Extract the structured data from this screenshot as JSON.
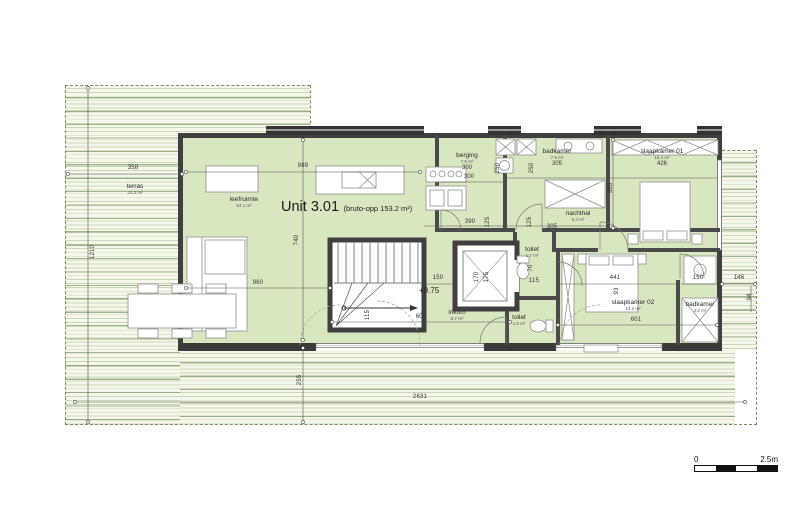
{
  "title": {
    "unit": "Unit 3.01",
    "gross": "(bruto-opp 153.2 m²)"
  },
  "annotations": {
    "level": "+9.75"
  },
  "scale_bar": {
    "left": "0",
    "right": "2.5m"
  },
  "plan": {
    "rooms": [
      {
        "name": "terras",
        "area": "43.3 m²",
        "x": 135,
        "y": 183
      },
      {
        "name": "leefruimte",
        "area": "54.1 m²",
        "x": 244,
        "y": 196
      },
      {
        "name": "berging",
        "area": "7.5 m²",
        "dim": "300",
        "x": 467,
        "y": 152
      },
      {
        "name": "badkamer",
        "area": "7.6 m²",
        "dim": "305",
        "x": 557,
        "y": 148
      },
      {
        "name": "slaapkamer 01",
        "area": "16.4 m²",
        "dim": "426",
        "x": 662,
        "y": 148
      },
      {
        "name": "nachthal",
        "area": "5.3 m²",
        "x": 578,
        "y": 210
      },
      {
        "name": "toilet",
        "area": "1.7 m²",
        "x": 532,
        "y": 246
      },
      {
        "name": "toilet",
        "area": "1.5 m²",
        "x": 519,
        "y": 314
      },
      {
        "name": "inkom",
        "area": "6.7 m²",
        "x": 457,
        "y": 309
      },
      {
        "name": "slaapkamer 02",
        "area": "13.2 m²",
        "x": 633,
        "y": 299
      },
      {
        "name": "badkamer",
        "area": "4.2 m²",
        "x": 700,
        "y": 301
      }
    ],
    "dimensions": [
      {
        "t": "358",
        "x": 133,
        "y": 168
      },
      {
        "t": "989",
        "x": 303,
        "y": 166
      },
      {
        "t": "1210",
        "x": 93,
        "y": 252,
        "r": true
      },
      {
        "t": "740",
        "x": 297,
        "y": 240,
        "r": true
      },
      {
        "t": "960",
        "x": 258,
        "y": 283
      },
      {
        "t": "300",
        "x": 469,
        "y": 177
      },
      {
        "t": "250",
        "x": 498,
        "y": 168,
        "r": true
      },
      {
        "t": "250",
        "x": 532,
        "y": 168,
        "r": true
      },
      {
        "t": "385",
        "x": 611,
        "y": 188,
        "r": true
      },
      {
        "t": "390",
        "x": 470,
        "y": 222
      },
      {
        "t": "125",
        "x": 488,
        "y": 222,
        "r": true
      },
      {
        "t": "125",
        "x": 530,
        "y": 222,
        "r": true
      },
      {
        "t": "305",
        "x": 552,
        "y": 227
      },
      {
        "t": "150",
        "x": 438,
        "y": 278
      },
      {
        "t": "170",
        "x": 477,
        "y": 277,
        "r": true
      },
      {
        "t": "175",
        "x": 487,
        "y": 277,
        "r": true
      },
      {
        "t": "70",
        "x": 531,
        "y": 268,
        "r": true
      },
      {
        "t": "115",
        "x": 534,
        "y": 281
      },
      {
        "t": "441",
        "x": 615,
        "y": 278
      },
      {
        "t": "93",
        "x": 617,
        "y": 291,
        "r": true
      },
      {
        "t": "150",
        "x": 698,
        "y": 278
      },
      {
        "t": "146",
        "x": 739,
        "y": 278
      },
      {
        "t": "94",
        "x": 750,
        "y": 297,
        "r": true
      },
      {
        "t": "115",
        "x": 368,
        "y": 315,
        "r": true
      },
      {
        "t": "605",
        "x": 421,
        "y": 317
      },
      {
        "t": "601",
        "x": 636,
        "y": 320
      },
      {
        "t": "255",
        "x": 300,
        "y": 380,
        "r": true
      },
      {
        "t": "2631",
        "x": 420,
        "y": 397
      }
    ]
  }
}
